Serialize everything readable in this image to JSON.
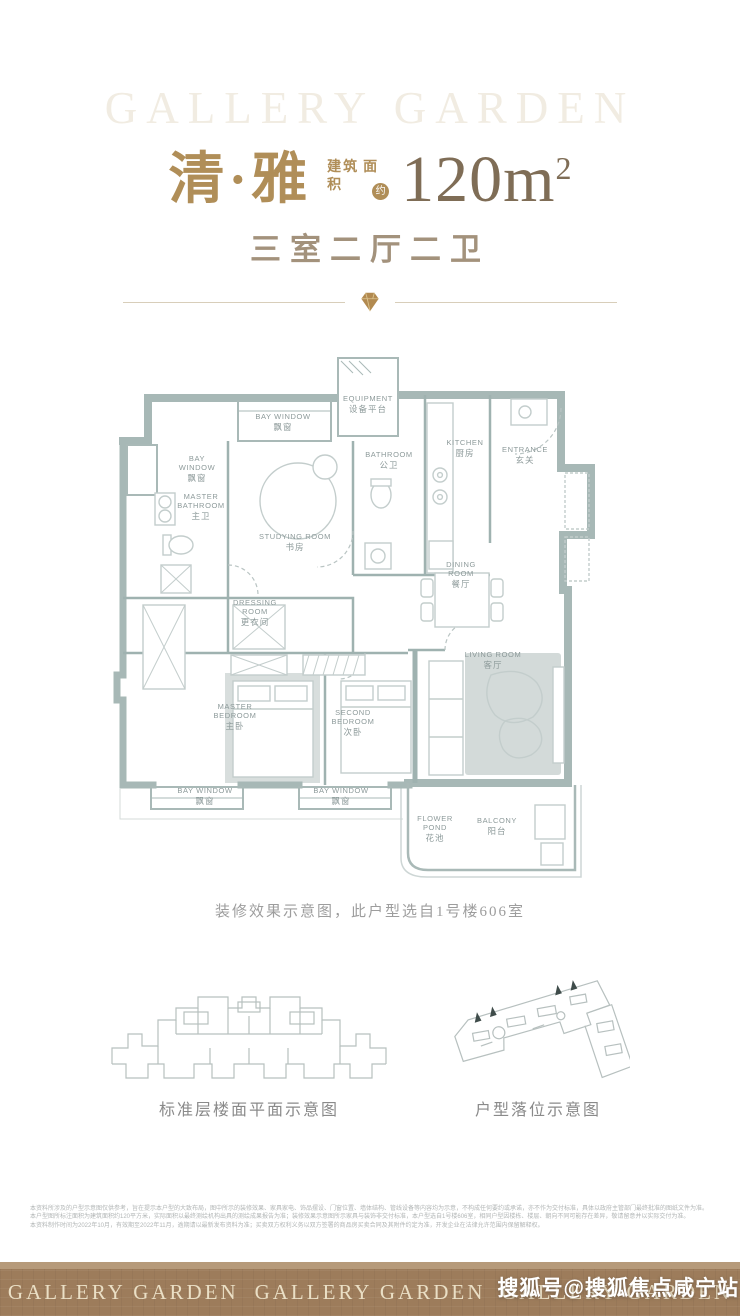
{
  "header": {
    "watermark": "GALLERY GARDEN",
    "title": "清·雅",
    "area_label_1": "建筑",
    "area_label_2": "面积",
    "area_approx": "约",
    "area_value": "120m",
    "area_sup": "2",
    "subtitle": "三室二厅二卫"
  },
  "floorplan": {
    "caption": "装修效果示意图，此户型选自1号楼606室",
    "wall_color": "#a7b8b6",
    "furniture_line_color": "#c3cdcc",
    "rug_color": "#d3dad9",
    "label_color": "#8d9a9a",
    "rooms": [
      {
        "en": "EQUIPMENT",
        "zh": "设备平台",
        "x": 255,
        "y": 48
      },
      {
        "en": "BAY WINDOW",
        "zh": "飘窗",
        "x": 170,
        "y": 66
      },
      {
        "en": "BATHROOM",
        "zh": "公卫",
        "x": 276,
        "y": 104
      },
      {
        "en": "KITCHEN",
        "zh": "厨房",
        "x": 352,
        "y": 92
      },
      {
        "en": "ENTRANCE",
        "zh": "玄关",
        "x": 412,
        "y": 99
      },
      {
        "en": "BAY\nWINDOW",
        "zh": "飘窗",
        "x": 84,
        "y": 108
      },
      {
        "en": "MASTER\nBATHROOM",
        "zh": "主卫",
        "x": 88,
        "y": 146
      },
      {
        "en": "STUDYING ROOM",
        "zh": "书房",
        "x": 182,
        "y": 186
      },
      {
        "en": "DINING\nROOM",
        "zh": "餐厅",
        "x": 348,
        "y": 214
      },
      {
        "en": "DRESSING\nROOM",
        "zh": "更衣间",
        "x": 142,
        "y": 252
      },
      {
        "en": "LIVING ROOM",
        "zh": "客厅",
        "x": 380,
        "y": 304
      },
      {
        "en": "MASTER\nBEDROOM",
        "zh": "主卧",
        "x": 122,
        "y": 356
      },
      {
        "en": "SECOND\nBEDROOM",
        "zh": "次卧",
        "x": 240,
        "y": 362
      },
      {
        "en": "BAY WINDOW",
        "zh": "飘窗",
        "x": 92,
        "y": 440
      },
      {
        "en": "BAY WINDOW",
        "zh": "飘窗",
        "x": 228,
        "y": 440
      },
      {
        "en": "FLOWER\nPOND",
        "zh": "花池",
        "x": 322,
        "y": 468
      },
      {
        "en": "BALCONY",
        "zh": "阳台",
        "x": 384,
        "y": 470
      }
    ]
  },
  "diagrams": {
    "left_caption": "标准层楼面平面示意图",
    "right_caption": "户型落位示意图"
  },
  "disclaimer": {
    "lines": [
      "本资料所涉及的户型示意图仅供参考，旨在提示本户型的大致布局，图中所示的装修效果、家具家电、饰品摆设、门窗位置、墙体结构、管线设备等内容均为示意，不构成任何要约或承诺，亦不作为交付标准，具体以政府主管部门最终批准的图纸文件为准。",
      "本户型图所标注面积为建筑面积约120平方米，实际面积以最终测绘机构出具的测绘成果报告为准；装修效果示意图所示家具与装饰非交付标准，本户型选自1号楼606室，相同户型因楼栋、楼层、朝向不同可能存在差异，敬请留意并以实际交付为准。",
      "本资料制作时间为2022年10月，有效期至2022年11月，逾期请以最新发布资料为准；买卖双方权利义务以双方签署的商品房买卖合同及其附件约定为准，开发企业在法律允许范围内保留解释权。"
    ]
  },
  "footer": {
    "brand": "GALLERY GARDEN",
    "bg_color": "#9d7c5b",
    "text_color": "#eadfc5"
  },
  "sohu_watermark": "搜狐号@搜狐焦点咸宁站",
  "accent_colors": {
    "gold": "#b08e58",
    "area_text": "#7f6d56",
    "wall_teal": "#a7b8b6",
    "footer_brown": "#9d7c5b"
  }
}
